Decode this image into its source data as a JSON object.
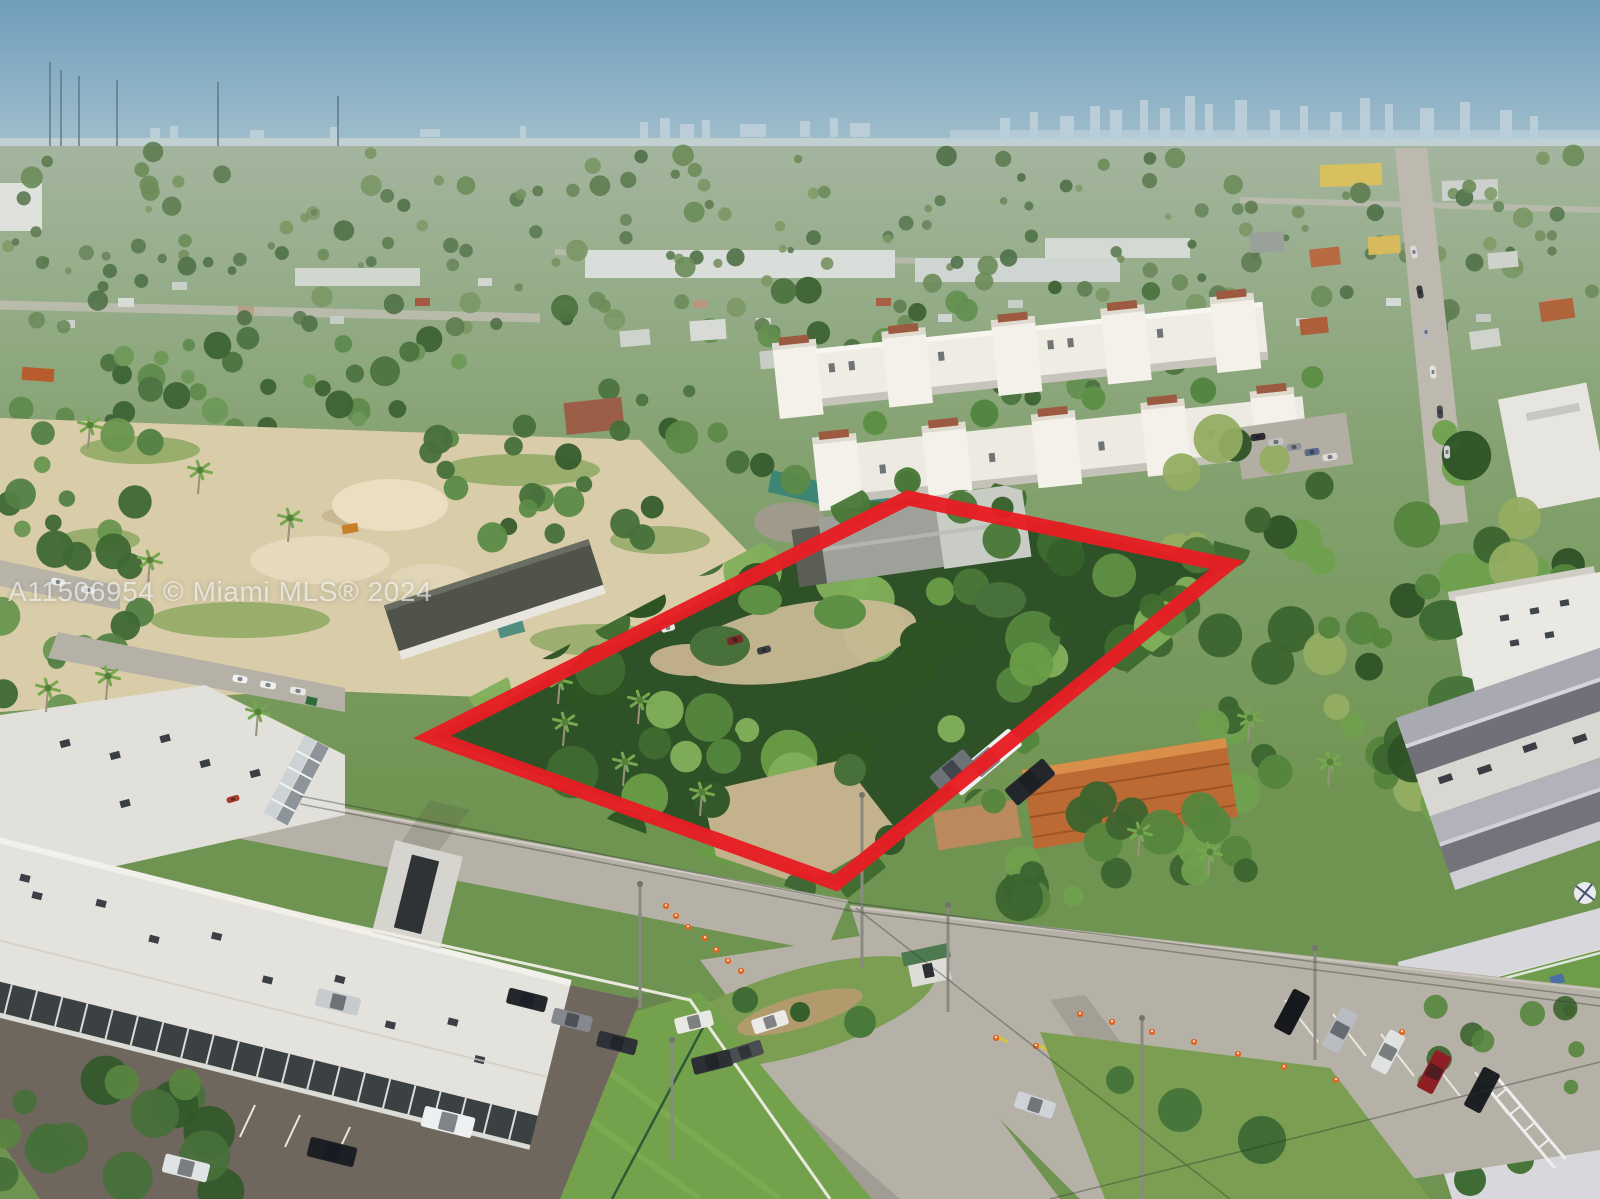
{
  "watermark": {
    "text": "A11506954 © Miami MLS® 2024",
    "color": "#ffffff",
    "opacity": 0.6
  },
  "property_outline": {
    "shape": "quadrilateral",
    "points": "908,498 1227,565 836,883 432,737",
    "color": "#e61e24",
    "stroke_width": 15
  },
  "scene": {
    "type": "aerial-drone-photograph",
    "description": "Aerial view of a Miami residential neighborhood; a red outline marks a tree-covered lot, with the downtown skyline on the hazy horizon.",
    "colors": {
      "sky_top": "#6f9dba",
      "sky_mid": "#9dbccb",
      "sky_horizon": "#cfdfe2",
      "skyline": "#bccfd9",
      "haze_band": "#ccd6d2",
      "distant_green": "#a3b59e",
      "mid_green": "#85a271",
      "near_green": "#6f9350",
      "sand": "#d8cca9",
      "sand_light": "#eadfc0",
      "road_concrete": "#b6b1a7",
      "asphalt": "#6f675d",
      "building_white": "#efece4",
      "roof_dark": "#4f5349",
      "roof_gray": "#9a9aa2",
      "roof_terracotta": "#bc6a33",
      "grass": "#7b9e52",
      "lawn": "#74a24c",
      "fence_white": "#efede5",
      "teal_fence": "#2f8177",
      "cone_orange": "#e2651f",
      "booth_roof": "#4d7a50",
      "outline_red": "#e61e24"
    },
    "landmarks": [
      {
        "name": "distant-miami-skyline"
      },
      {
        "name": "radio-antenna-masts"
      },
      {
        "name": "white-condo-complex"
      },
      {
        "name": "vacant-sandy-lot"
      },
      {
        "name": "outlined-property-tree-canopy"
      },
      {
        "name": "orange-tile-roof-house"
      },
      {
        "name": "white-apartment-buildings"
      },
      {
        "name": "gray-roof-apartment-building"
      },
      {
        "name": "street-intersection-with-cones"
      },
      {
        "name": "guard-booth"
      },
      {
        "name": "parking-lots-with-cars"
      }
    ]
  }
}
